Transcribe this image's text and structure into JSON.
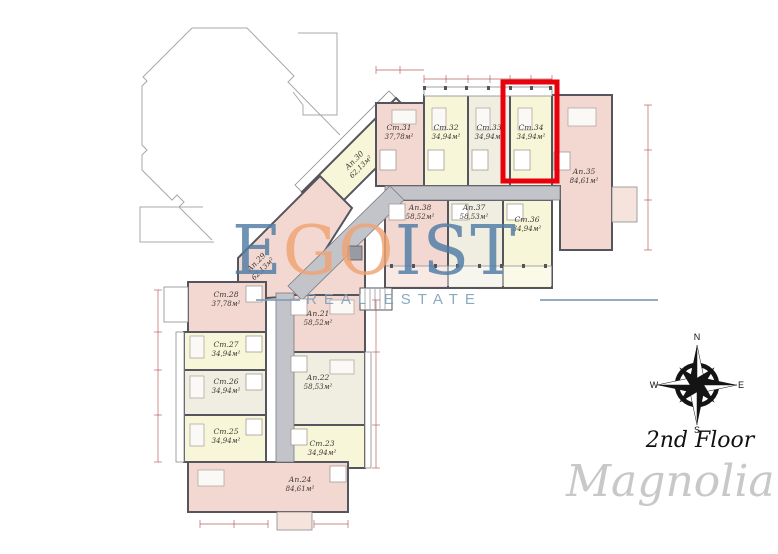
{
  "brand": {
    "logo_letters": [
      {
        "ch": "E",
        "color": "#4f7ca6"
      },
      {
        "ch": "G",
        "color": "#f0a474"
      },
      {
        "ch": "O",
        "color": "#f0a474"
      },
      {
        "ch": "I",
        "color": "#4f7ca6"
      },
      {
        "ch": "S",
        "color": "#4f7ca6"
      },
      {
        "ch": "T",
        "color": "#4f7ca6"
      }
    ],
    "tagline": "REAL ESTATE",
    "project_name": "Magnolia"
  },
  "floor": {
    "label": "2nd Floor"
  },
  "compass": {
    "n": "N",
    "e": "E",
    "s": "S",
    "w": "W"
  },
  "highlight": {
    "unit": "Ст.34",
    "color": "#e8000d"
  },
  "palette": {
    "studio_yellow": "#f8f6d8",
    "apartment_pink": "#f2d8d0",
    "unit_ivory": "#f0eee1",
    "corridor_gray": "#c3c4ca",
    "wall_dark": "#55555d",
    "dimension_red": "#b04545"
  },
  "units": [
    {
      "id": "Ап.21",
      "area": "58,52м²"
    },
    {
      "id": "Ап.22",
      "area": "58,53м²"
    },
    {
      "id": "Ст.23",
      "area": "34,94м²"
    },
    {
      "id": "Ап.24",
      "area": "84,61м²"
    },
    {
      "id": "Ст.25",
      "area": "34,94м²"
    },
    {
      "id": "Ст.26",
      "area": "34,94м²"
    },
    {
      "id": "Ст.27",
      "area": "34,94м²"
    },
    {
      "id": "Ст.28",
      "area": "37,78м²"
    },
    {
      "id": "Ап.29",
      "area": "62,13м²"
    },
    {
      "id": "Ап.30",
      "area": "62,13м²"
    },
    {
      "id": "Ст.31",
      "area": "37,78м²"
    },
    {
      "id": "Ст.32",
      "area": "34,94м²"
    },
    {
      "id": "Ст.33",
      "area": "34,94м²"
    },
    {
      "id": "Ст.34",
      "area": "34,94м²"
    },
    {
      "id": "Ап.35",
      "area": "84,61м²"
    },
    {
      "id": "Ст.36",
      "area": "34,94м²"
    },
    {
      "id": "Ап.37",
      "area": "58,53м²"
    },
    {
      "id": "Ап.38",
      "area": "58,52м²"
    }
  ]
}
